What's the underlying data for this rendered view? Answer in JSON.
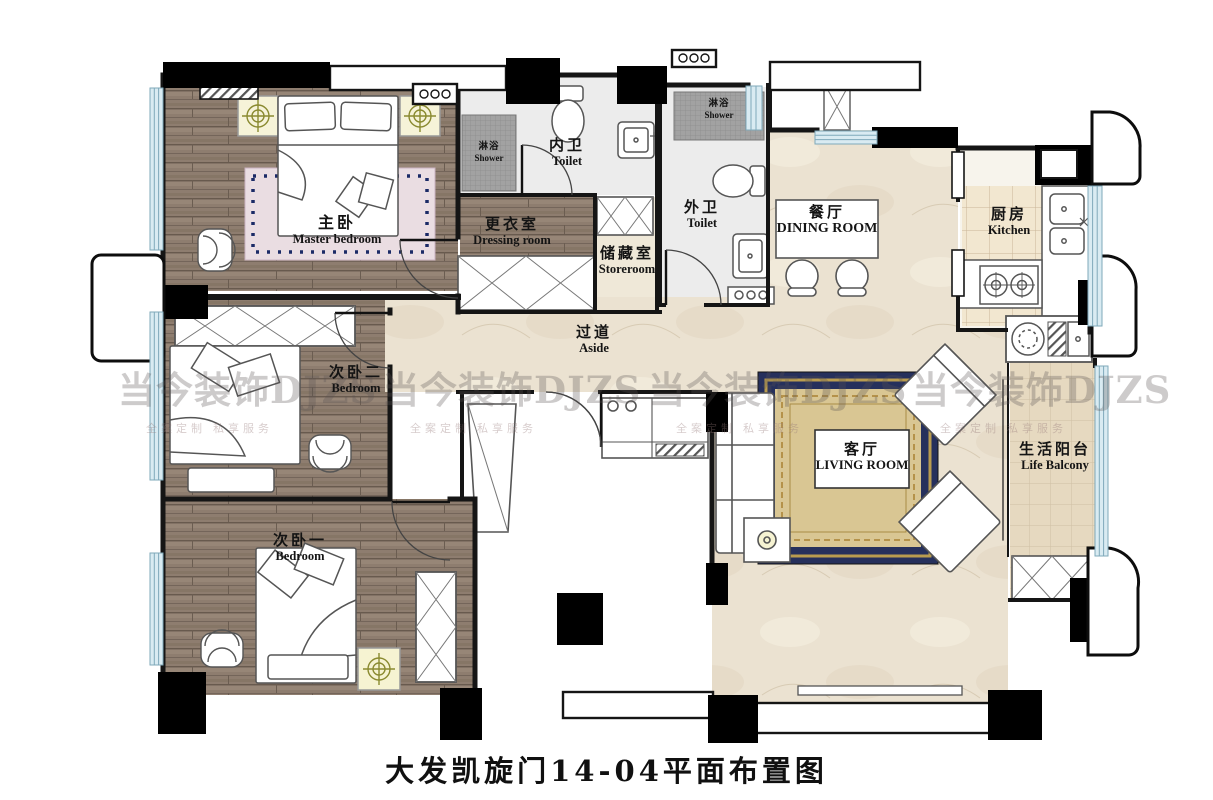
{
  "title": "大发凯旋门14-04平面布置图",
  "watermark": {
    "brand": "当今装饰DJZS",
    "slogan": "全案定制 私享服务"
  },
  "rooms": {
    "master_bedroom": {
      "zh": "主卧",
      "en": "Master bedroom"
    },
    "dressing_room": {
      "zh": "更衣室",
      "en": "Dressing room"
    },
    "inner_toilet": {
      "zh": "内卫",
      "en": "Toilet"
    },
    "shower_inner": {
      "zh": "淋浴",
      "en": "Shower"
    },
    "storeroom": {
      "zh": "储藏室",
      "en": "Storeroom"
    },
    "outer_toilet": {
      "zh": "外卫",
      "en": "Toilet"
    },
    "shower_outer": {
      "zh": "淋浴",
      "en": "Shower"
    },
    "dining_room": {
      "zh": "餐厅",
      "en": "DINING ROOM"
    },
    "kitchen": {
      "zh": "厨房",
      "en": "Kitchen"
    },
    "aside": {
      "zh": "过道",
      "en": "Aside"
    },
    "bedroom_two": {
      "zh": "次卧二",
      "en": "Bedroom"
    },
    "bedroom_one": {
      "zh": "次卧一",
      "en": "Bedroom"
    },
    "living_room": {
      "zh": "客厅",
      "en": "LIVING ROOM"
    },
    "life_balcony": {
      "zh": "生活阳台",
      "en": "Life Balcony"
    }
  },
  "colors": {
    "wall": "#151515",
    "wood_floor": "#8e7d6f",
    "marble_floor": "#ebe2d1",
    "kitchen_tile": "#f2e7d0",
    "balcony_tile": "#e6d9c0",
    "window_glass": "#d9ebf2",
    "shower_tile": "#a2a2a2",
    "carpet_navy": "#26305c",
    "carpet_gold": "#d9c693",
    "lamp_symbol": "#8a8a30"
  }
}
